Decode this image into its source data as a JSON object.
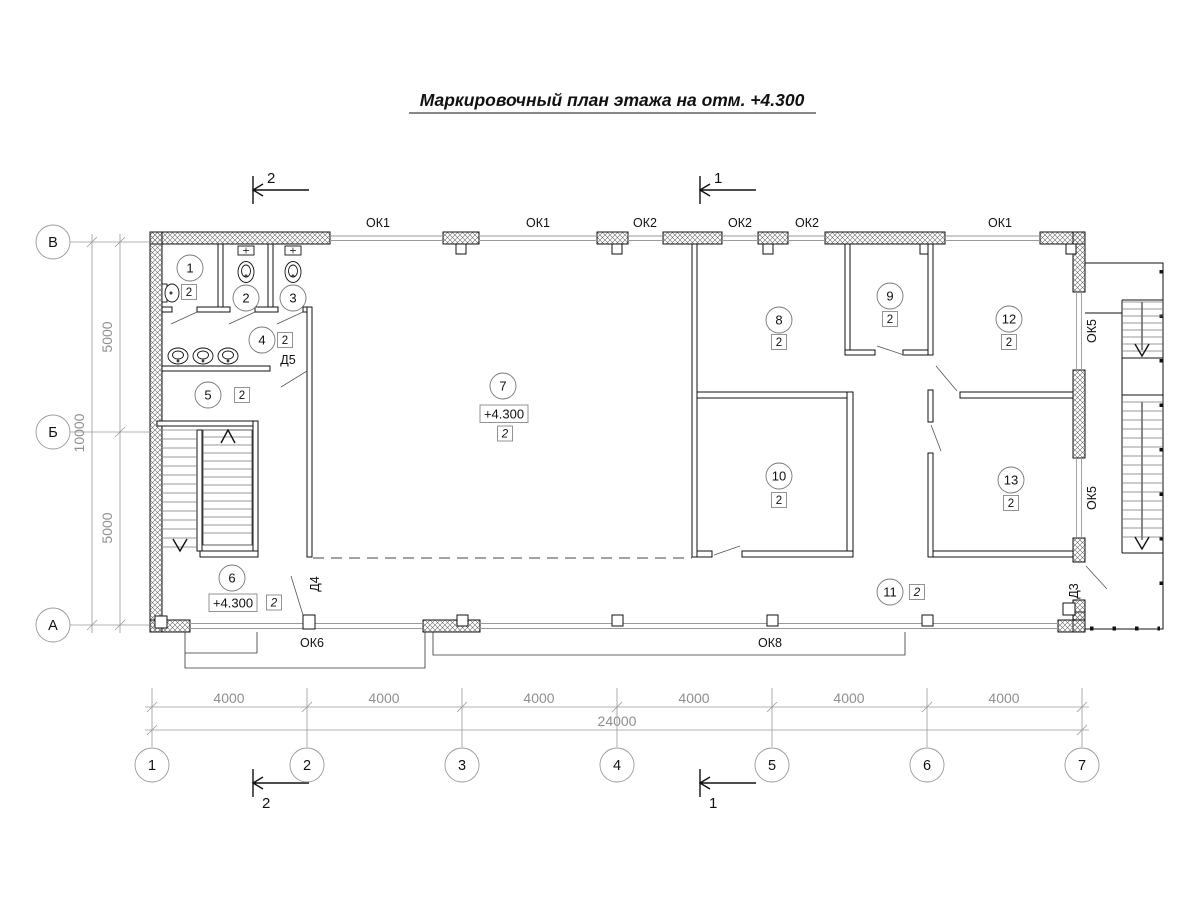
{
  "title": "Маркировочный план этажа на отм. +4.300",
  "colors": {
    "ink": "#111111",
    "dim_gray": "#9a9a9a"
  },
  "axes": {
    "cols": [
      "1",
      "2",
      "3",
      "4",
      "5",
      "6",
      "7"
    ],
    "rows": [
      "В",
      "Б",
      "А"
    ]
  },
  "dimensions": {
    "col_segments": [
      "4000",
      "4000",
      "4000",
      "4000",
      "4000",
      "4000"
    ],
    "col_total": "24000",
    "row_segments": [
      "5000",
      "5000"
    ],
    "row_total": "10000"
  },
  "sections": {
    "one": "1",
    "two": "2"
  },
  "windows": {
    "top": [
      "ОК1",
      "ОК1",
      "ОК2",
      "ОК2",
      "ОК2",
      "ОК1"
    ],
    "right": [
      "ОК5",
      "ОК5"
    ],
    "bottom": [
      "ОК6",
      "ОК8"
    ]
  },
  "doors": [
    "Д5",
    "Д4",
    "Д3"
  ],
  "elevations": {
    "stair_hall": "+4.300",
    "main_hall": "+4.300"
  },
  "rooms": [
    {
      "num": "1",
      "grade": "2"
    },
    {
      "num": "2"
    },
    {
      "num": "3"
    },
    {
      "num": "4",
      "grade": "2"
    },
    {
      "num": "5",
      "grade": "2"
    },
    {
      "num": "6",
      "grade": "2"
    },
    {
      "num": "7",
      "grade": "2"
    },
    {
      "num": "8",
      "grade": "2"
    },
    {
      "num": "9",
      "grade": "2"
    },
    {
      "num": "10",
      "grade": "2"
    },
    {
      "num": "11",
      "grade": "2"
    },
    {
      "num": "12",
      "grade": "2"
    },
    {
      "num": "13",
      "grade": "2"
    }
  ]
}
